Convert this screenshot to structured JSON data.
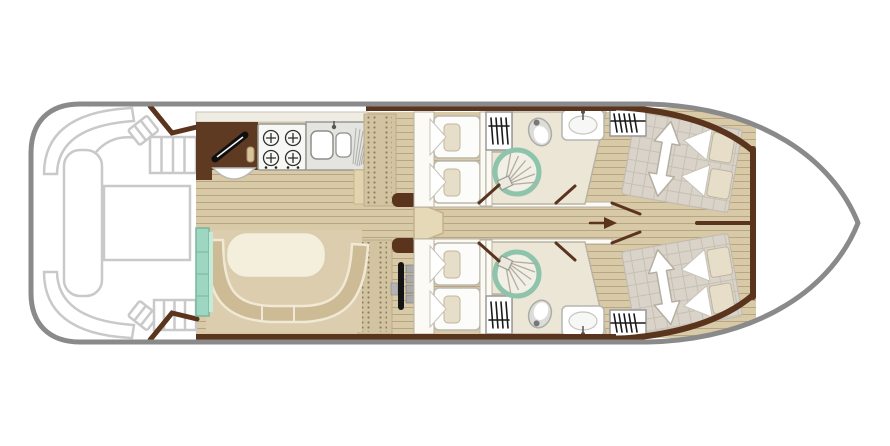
{
  "page": {
    "background": "#ffffff"
  },
  "colors": {
    "hull_outline": "#8a8a8a",
    "deck_outline": "#c9c9c9",
    "wood_floor": "#d8c9a7",
    "wood_plank_line": "#b9a584",
    "wall_brown": "#5a341c",
    "galley_cabinet": "#5e3a22",
    "dinette_sofa": "#ccbb94",
    "dinette_table": "#f4eedd",
    "counter_teal": "#9fd6c2",
    "shower_teal": "#8ec4ab",
    "bathroom_floor": "#ece6d6",
    "mattress_gray": "#d9d3c9",
    "bed_linen": "#fcfcfa",
    "pillow_beige": "#e6dec8",
    "steps_dot": "#8f7f60"
  },
  "boat_plan": {
    "type": "boat-floor-plan",
    "orientation": "bow-right",
    "areas": [
      {
        "id": "stern-deck",
        "features": [
          "corner-bench-port",
          "corner-bench-starboard",
          "stern-bench",
          "deck-table",
          "side-seat-port",
          "side-seat-starboard",
          "boarding-steps-port",
          "boarding-steps-starboard",
          "entry-bulkhead-port",
          "entry-bulkhead-starboard"
        ]
      },
      {
        "id": "galley",
        "features": [
          "kitchen-cabinet",
          "worktop-hatch-handle",
          "round-basin",
          "gas-hob-4-burner",
          "double-sink-with-drainer",
          "side-locker"
        ]
      },
      {
        "id": "saloon",
        "features": [
          "u-shaped-dinette-sofa",
          "oval-table",
          "teal-sideboard",
          "side-steps-port",
          "side-steps-starboard",
          "corridor-step"
        ]
      },
      {
        "id": "helm-station",
        "features": [
          "steering-wheel",
          "throttle-levers",
          "dashboard"
        ]
      },
      {
        "id": "midship-cabin-port",
        "features": [
          "single-bed",
          "single-bed",
          "pillows",
          "wardrobe",
          "door"
        ]
      },
      {
        "id": "midship-bathroom-port",
        "features": [
          "shower",
          "toilet",
          "washbasin",
          "door"
        ]
      },
      {
        "id": "midship-cabin-starboard",
        "features": [
          "single-bed",
          "single-bed",
          "pillows",
          "wardrobe",
          "door"
        ]
      },
      {
        "id": "midship-bathroom-starboard",
        "features": [
          "shower",
          "toilet",
          "washbasin",
          "door"
        ]
      },
      {
        "id": "bow-cabin-port",
        "features": [
          "double-bed-sliding",
          "bed-extension-arrow",
          "pillows",
          "wardrobe",
          "door"
        ]
      },
      {
        "id": "bow-cabin-starboard",
        "features": [
          "double-bed-sliding",
          "bed-extension-arrow",
          "pillows",
          "wardrobe",
          "door"
        ]
      },
      {
        "id": "bow-deck",
        "features": []
      },
      {
        "id": "corridor",
        "features": [
          "passage-arrow"
        ]
      }
    ]
  }
}
